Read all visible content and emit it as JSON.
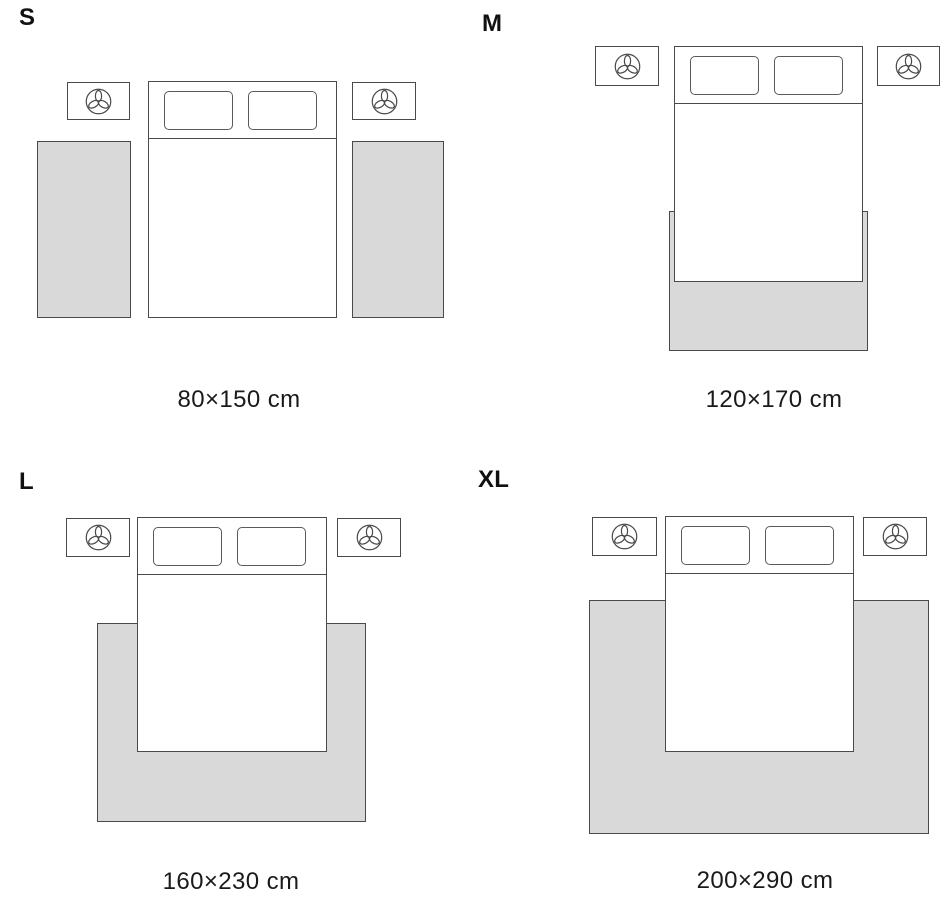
{
  "colors": {
    "background": "#ffffff",
    "outline": "#4a4a4a",
    "rug_fill": "#d9d9d9",
    "text": "#1a1a1a"
  },
  "icons": {
    "nightstand_icon": "plant-icon"
  },
  "panels": [
    {
      "label": "S",
      "caption": "80×150 cm"
    },
    {
      "label": "M",
      "caption": "120×170 cm"
    },
    {
      "label": "L",
      "caption": "160×230 cm"
    },
    {
      "label": "XL",
      "caption": "200×290 cm"
    }
  ]
}
